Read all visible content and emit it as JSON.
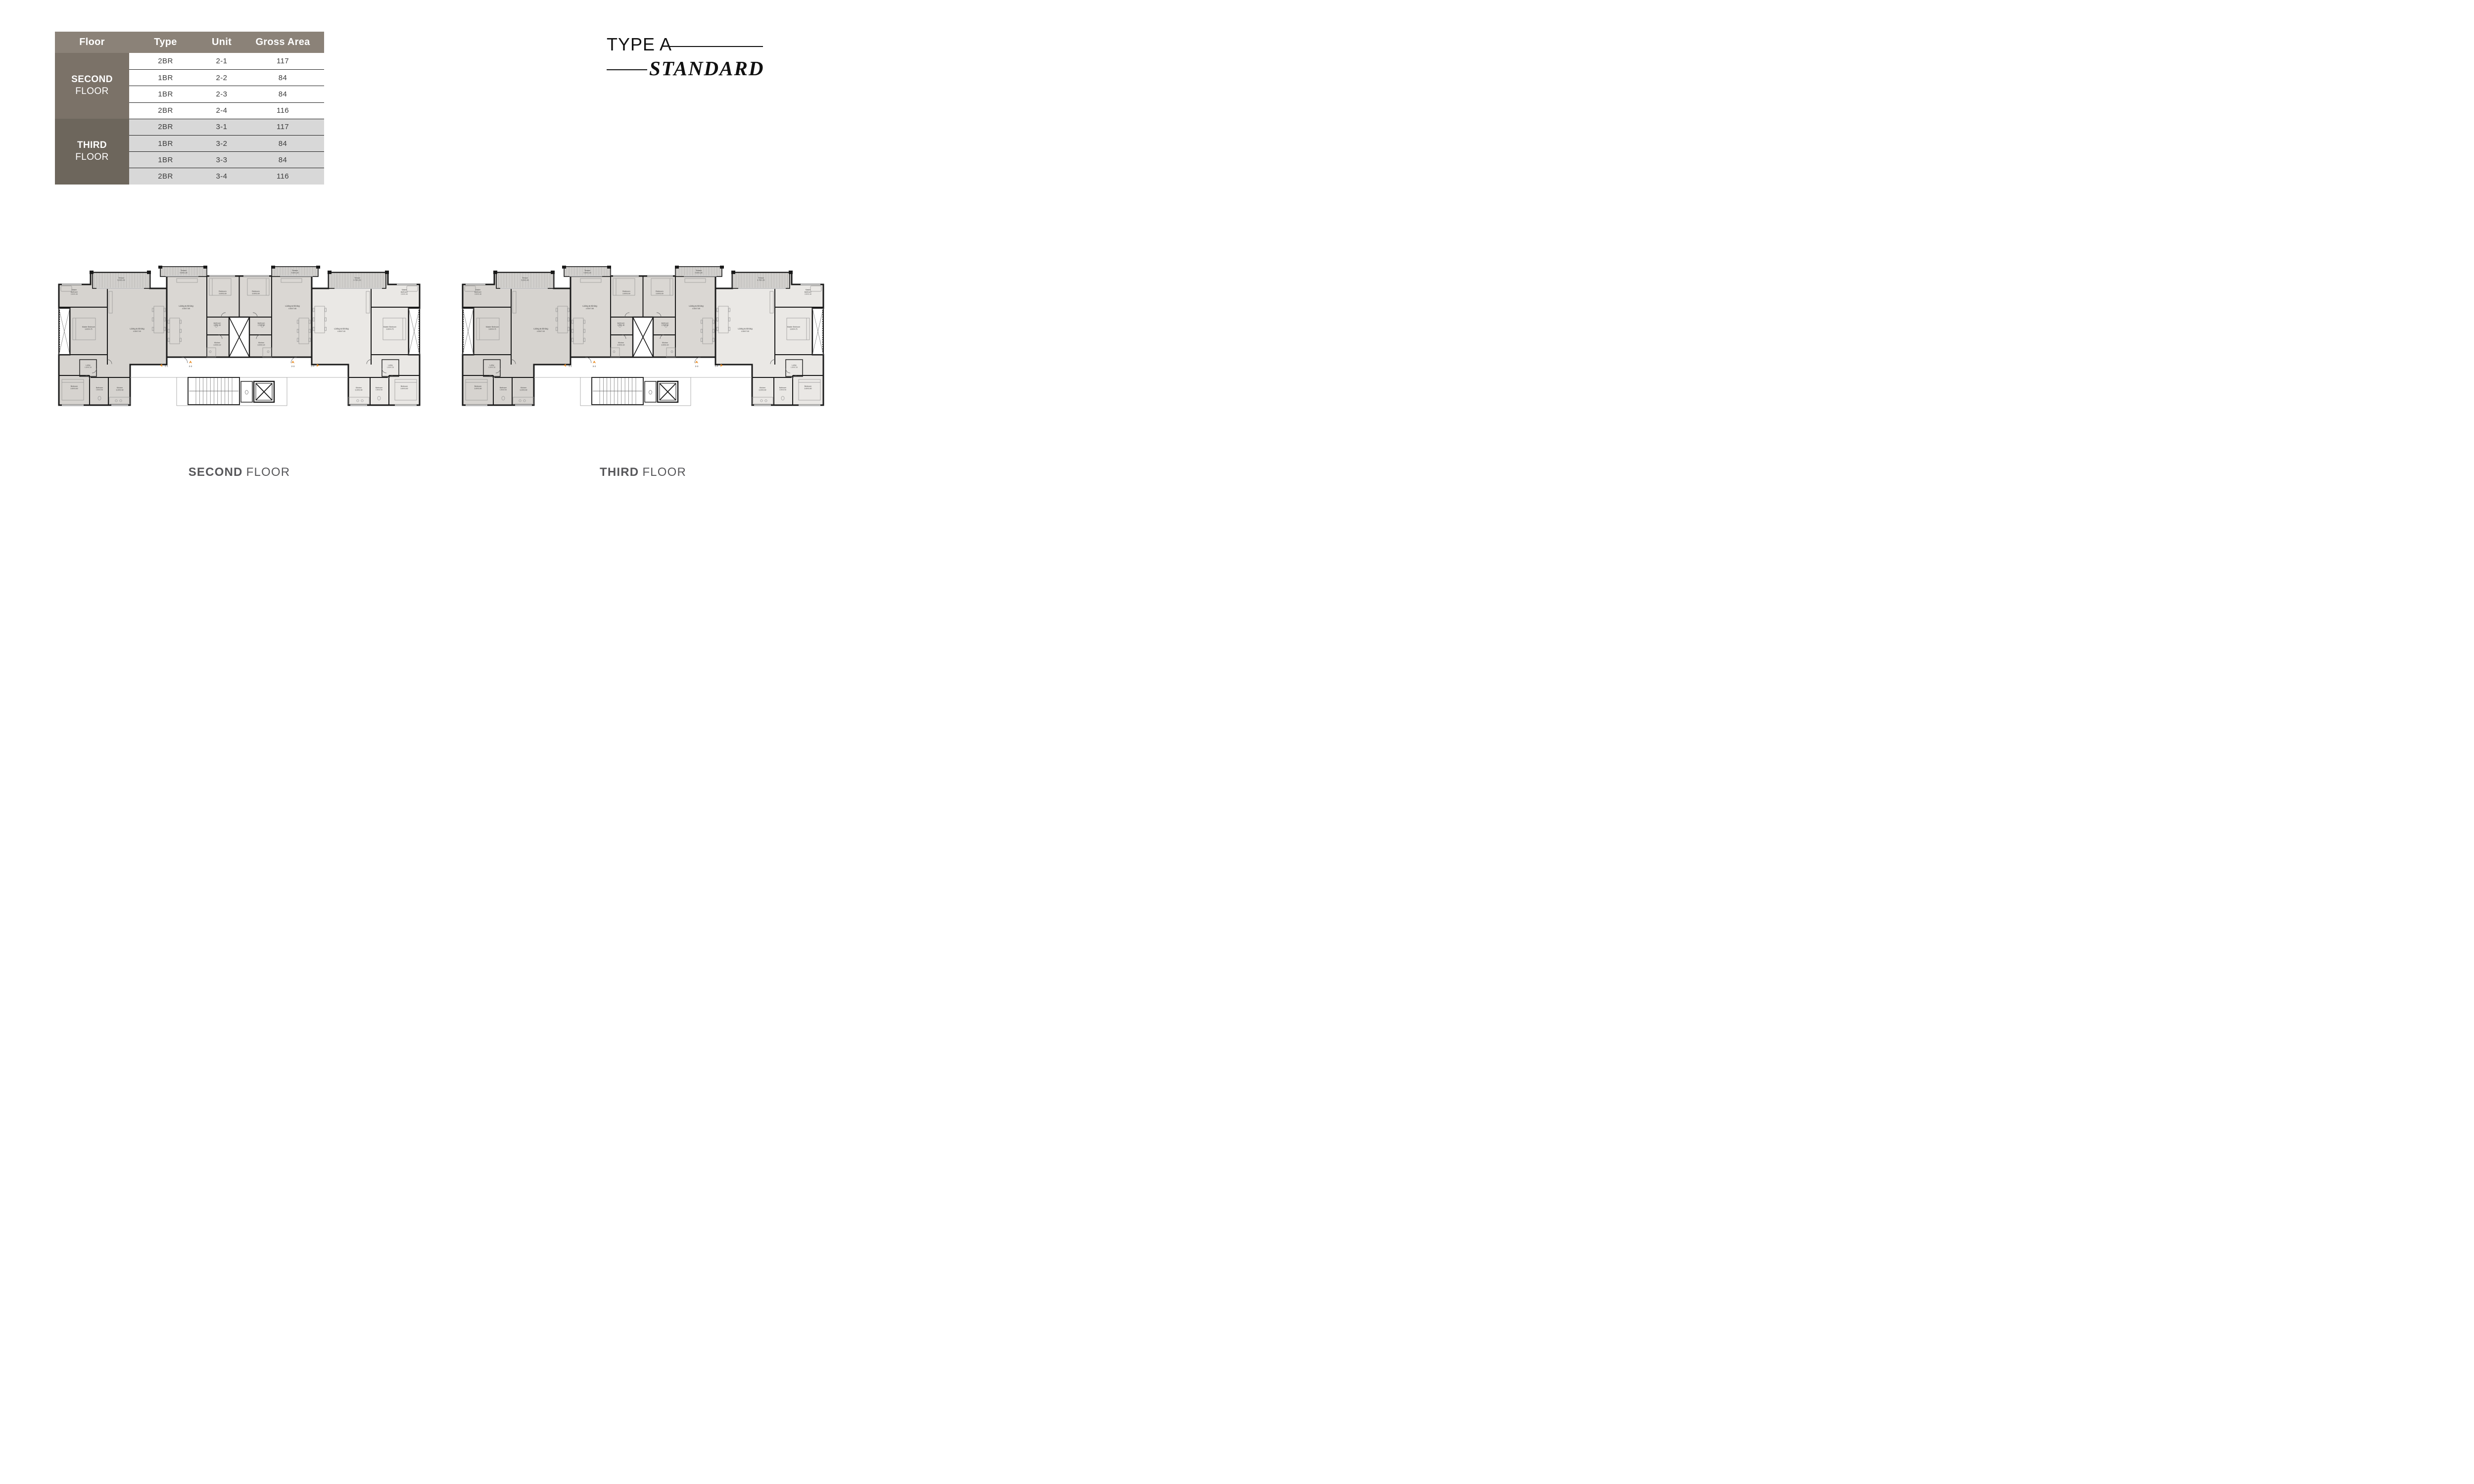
{
  "title": {
    "line1": "TYPE A",
    "line2": "STANDARD"
  },
  "table": {
    "headers": [
      "Floor",
      "Type",
      "Unit",
      "Gross Area"
    ],
    "groups": [
      {
        "floor_bold": "SECOND",
        "floor_light": "FLOOR",
        "rows": [
          [
            "2BR",
            "2-1",
            "117"
          ],
          [
            "1BR",
            "2-2",
            "84"
          ],
          [
            "1BR",
            "2-3",
            "84"
          ],
          [
            "2BR",
            "2-4",
            "116"
          ]
        ]
      },
      {
        "floor_bold": "THIRD",
        "floor_light": "FLOOR",
        "rows": [
          [
            "2BR",
            "3-1",
            "117"
          ],
          [
            "1BR",
            "3-2",
            "84"
          ],
          [
            "1BR",
            "3-3",
            "84"
          ],
          [
            "2BR",
            "3-4",
            "116"
          ]
        ]
      }
    ]
  },
  "plans": [
    {
      "caption_bold": "SECOND",
      "caption_light": "FLOOR",
      "units": [
        "2-1",
        "2-2",
        "2-3",
        "2-4"
      ]
    },
    {
      "caption_bold": "THIRD",
      "caption_light": "FLOOR",
      "units": [
        "3-1",
        "3-2",
        "3-3",
        "3-4"
      ]
    }
  ],
  "rooms": {
    "terrace_center": {
      "name": "Terrace",
      "dims": "4.60X1.25"
    },
    "terrace_left_wing": {
      "name": "Terrace",
      "dims": "5.25X1.40"
    },
    "terrace_right_wing": {
      "name": "Terrace",
      "dims": "4.75X1.50"
    },
    "bedroom_center": {
      "name": "Bedroom",
      "dims": "3.60X3.60"
    },
    "living_center": {
      "name": "Living & Dining",
      "dims": "4.50X7.85"
    },
    "bath_center": {
      "name": "Bathroom",
      "dims": "2.25X1.80"
    },
    "kitchen_center": {
      "name": "Kitchen",
      "dims": "3.00X2.20"
    },
    "master_bath": {
      "line1": "Master",
      "line2": "Bathroom",
      "dims": "2.60X1.80"
    },
    "master_bed": {
      "name": "Master Bedroom",
      "dims": "3.60X4.75"
    },
    "living_wing": {
      "name": "Living & Dining",
      "dims": "4.50X7.00"
    },
    "lobby": {
      "name": "Lobby",
      "dims": "1.50X1.35"
    },
    "bedroom_wing": {
      "name": "Bedroom",
      "dims": "3.60X3.60"
    },
    "bath_wing": {
      "name": "Bathroom",
      "dims": "1.80X2.60"
    },
    "kitchen_wing": {
      "name": "Kitchen",
      "dims": "3.20X2.60"
    }
  },
  "colors": {
    "header_bg": "#8b8278",
    "second_cell_bg": "#7b7268",
    "third_cell_bg": "#6d665c",
    "alt_row_bg": "#d8d8d8",
    "accent_orange": "#e9891f",
    "wall": "#1a1a1a",
    "wing_left_fill": "#d6d3cf",
    "wing_right_fill": "#eae8e5",
    "central_fill": "#dad7d3",
    "caption_color": "#57575a"
  }
}
